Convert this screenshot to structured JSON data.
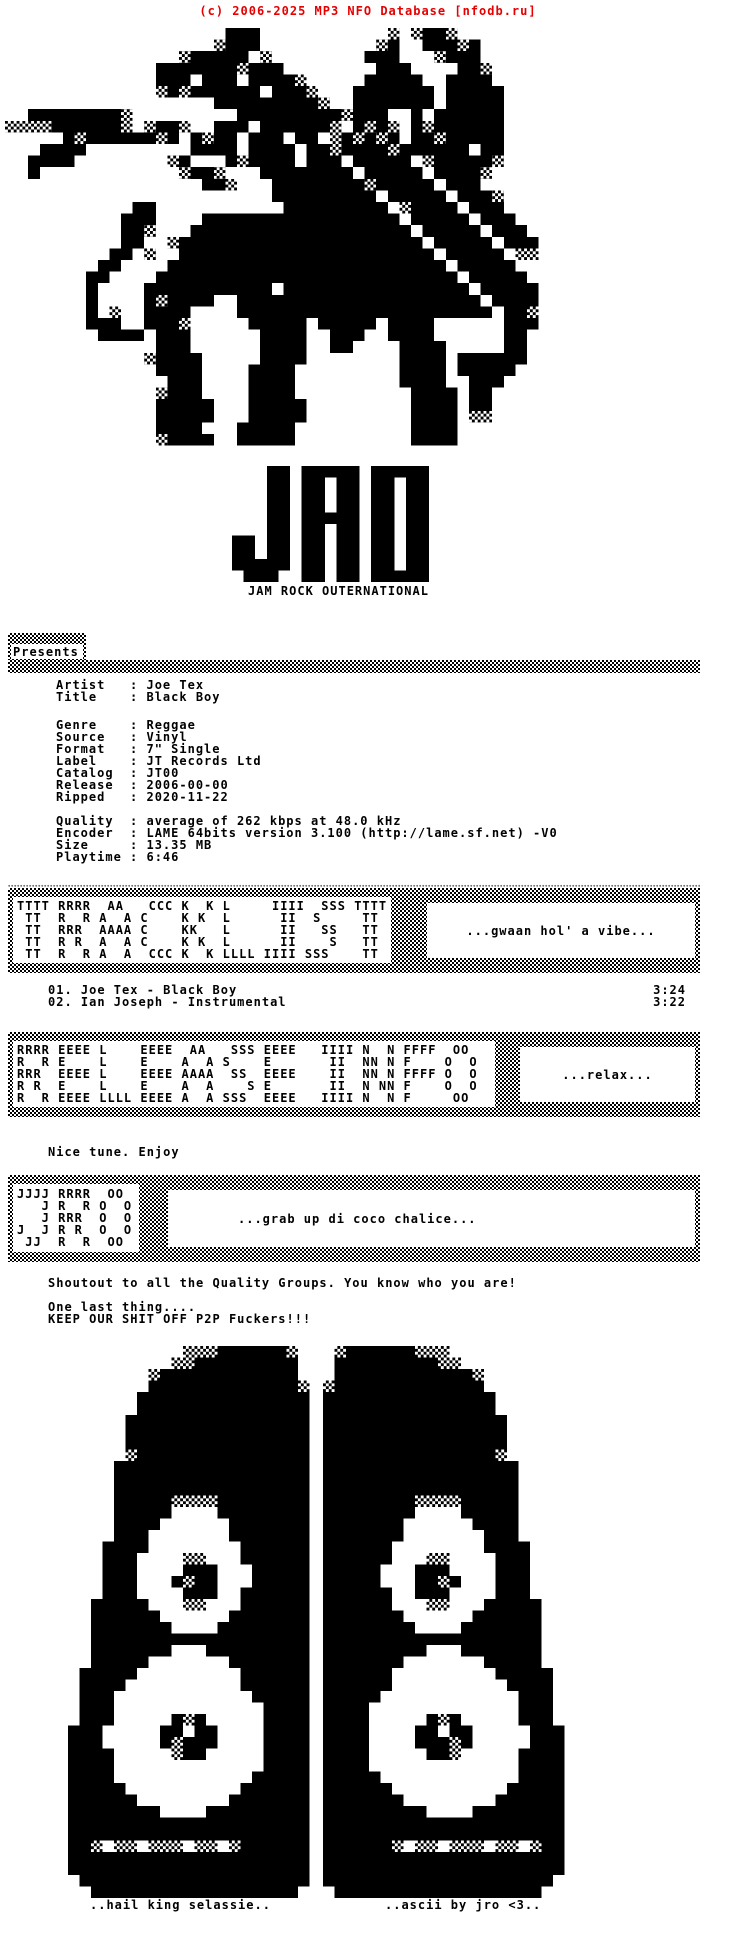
{
  "header": {
    "text": "(c) 2006-2025 MP3 NFO Database [nfodb.ru]",
    "color": "#e60000"
  },
  "logo": {
    "big_text": "JRO",
    "tagline": "JAM ROCK OUTERNATIONAL"
  },
  "presents": {
    "label": "Presents"
  },
  "release_info": {
    "artist_block": [
      {
        "label": "Artist",
        "value": "Joe Tex"
      },
      {
        "label": "Title",
        "value": "Black Boy"
      }
    ],
    "source_block": [
      {
        "label": "Genre",
        "value": "Reggae"
      },
      {
        "label": "Source",
        "value": "Vinyl"
      },
      {
        "label": "Format",
        "value": "7\" Single"
      },
      {
        "label": "Label",
        "value": "JT Records Ltd"
      },
      {
        "label": "Catalog",
        "value": "JT00"
      },
      {
        "label": "Release",
        "value": "2006-00-00"
      },
      {
        "label": "Ripped",
        "value": "2020-11-22"
      }
    ],
    "audio_block": [
      {
        "label": "Quality",
        "value": "average of 262 kbps at 48.0 kHz"
      },
      {
        "label": "Encoder",
        "value": "LAME 64bits version 3.100 (http://lame.sf.net) -V0"
      },
      {
        "label": "Size",
        "value": "13.35 MB"
      },
      {
        "label": "Playtime",
        "value": "6:46"
      }
    ]
  },
  "banners": {
    "tracklist": {
      "ascii": [
        "TTTT RRRR  AA   CCC K  K L     IIII  SSS TTTT",
        " TT  R  R A  A C    K K  L      II  S     TT",
        " TT  RRR  AAAA C    KK   L      II   SS   TT",
        " TT  R R  A  A C    K K  L      II    S   TT",
        " TT  R  R A  A  CCC K  K LLLL IIII SSS    TT"
      ],
      "note": "...gwaan hol' a vibe..."
    },
    "release": {
      "ascii": [
        "RRRR EEEE L    EEEE  AA   SSS EEEE   IIII N  N FFFF  OO",
        "R  R E    L    E    A  A S    E       II  NN N F    O  O",
        "RRR  EEEE L    EEEE AAAA  SS  EEEE    II  NN N FFFF O  O",
        "R R  E    L    E    A  A    S E       II  N NN F    O  O",
        "R  R EEEE LLLL EEEE A  A SSS  EEEE   IIII N  N F     OO"
      ],
      "note": "...relax..."
    },
    "jro": {
      "ascii": [
        "JJJJ RRRR  OO",
        "   J R  R O  O",
        "   J RRR  O  O",
        "J  J R R  O  O",
        " JJ  R  R  OO"
      ],
      "note": "...grab up di coco chalice..."
    }
  },
  "tracks": [
    {
      "num": "01.",
      "title": "Joe Tex - Black Boy",
      "duration": "3:24"
    },
    {
      "num": "02.",
      "title": "Ian Joseph - Instrumental",
      "duration": "3:22"
    }
  ],
  "messages": {
    "enjoy": "Nice tune. Enjoy",
    "shoutout": "Shoutout to all the Quality Groups. You know who you are!",
    "last_thing": "One last thing....",
    "warning": "KEEP OUR SHIT OFF P2P Fuckers!!!"
  },
  "footer": {
    "left": "..hail king selassie..",
    "right": "..ascii by jro <3.."
  },
  "pixel_art": {
    "lion": {
      "name": "rasta-lion-with-flag",
      "cell": 11.6,
      "rows": [
        "                   ###           + +##+       ",
        "                  +###          +#  ###+#     ",
        "               +##### +        ###   +###     ",
        "             #######+###        ###    ##+    ",
        "             ### ### ####+     #####  ####    ",
        "             +#+###### ###+   ####### #####   ",
        "                  #########+  ####### #####   ",
        "  ########+         #########+###  # ######   ",
        "++++######+ +##+  ### ######+ #+#+ #+######   ",
        "     #+######+# #+## ### ## +#+#+# ##+#####   ",
        "   ####         #### #### ##+####+###### ##   ",
        "  ####        +#   #+#### ### ##### +#####+   ",
        "  #            +##+   ######## ##### ####+    ",
        "                 ##+   ########+##### ###     ",
        "                       ######### ##### ###+   ",
        "           ##           ######### +#### ###   ",
        "          ###    ################# ##### ###  ",
        "          ##+   ################### ##### ### ",
        "          ##  +##################### ##### ###",
        "         ## +  ###################### ##### ++",
        "        ##    ######################## #####  ",
        "       ##    ########################## ##### ",
        "       #    ########### ################ #####",
        "       #    #+####  ##################### ####",
        "       # +  ####    ###################### ##+",
        "       ###  ###+     ##### ##### ####      ###",
        "        #### ###      ####  ###  ####      ## ",
        "             ###      ####  ##    ####     ## ",
        "            +####     ####        #### ###### ",
        "             ####    ####         #### #####  ",
        "              ###    ####         ####  ###   ",
        "             +###    ####          #### ##    ",
        "             #####   #####         #### ##    ",
        "             #####   #####         #### ++    ",
        "             ####   #####          ####       ",
        "             +####  #####          ####       "
      ]
    },
    "jro_logo": {
      "name": "jro-block-letters",
      "cell": 11.6,
      "rows": [
        "   ## ##### #####",
        "   ## ## ## ## ##",
        "   ## ## ## ## ##",
        "   ## ## ## ## ##",
        "   ## ##### ## ##",
        "   ## ## ## ## ##",
        "## ## ## ## ## ##",
        "## ## ## ## ## ##",
        "##### ## ## ## ##",
        " ###  ## ## #####"
      ]
    },
    "speaker": {
      "name": "speaker-tower",
      "cell": 11.5,
      "rows": [
        "          +++######+ ",
        "         ++######### ",
        "       +############ ",
        "       #############+",
        "      ###############",
        "      ###############",
        "     ################",
        "     ################",
        "     ################",
        "     +###############",
        "    #################",
        "    #################",
        "    #################",
        "    #####++++########",
        "    #####    ########",
        "    ####      #######",
        "    ###       #######",
        "   ####        ######",
        "   ###    ++   ######",
        "   ###    ###   #####",
        "   ###   #+##   #####",
        "   ###    ###  ######",
        "  #####   ++   ######",
        "  ######      #######",
        "  #######    ########",
        "  ###################",
        "  #######   #########",
        "  #####       #######",
        " #####         ######",
        " ####          ######",
        " ###            #####",
        " ###             ####",
        " ###     #+#     ####",
        "###     ## ##    ####",
        "###     #+###    ####",
        "####     +##     ####",
        "####             ####",
        "####            #####",
        "#####          ######",
        "######        #######",
        "########    #########",
        "#####################",
        "#####################",
        "##+ ++ +++ ++ +######",
        "#####################",
        "#####################",
        " ####################",
        "  ################## "
      ]
    }
  }
}
